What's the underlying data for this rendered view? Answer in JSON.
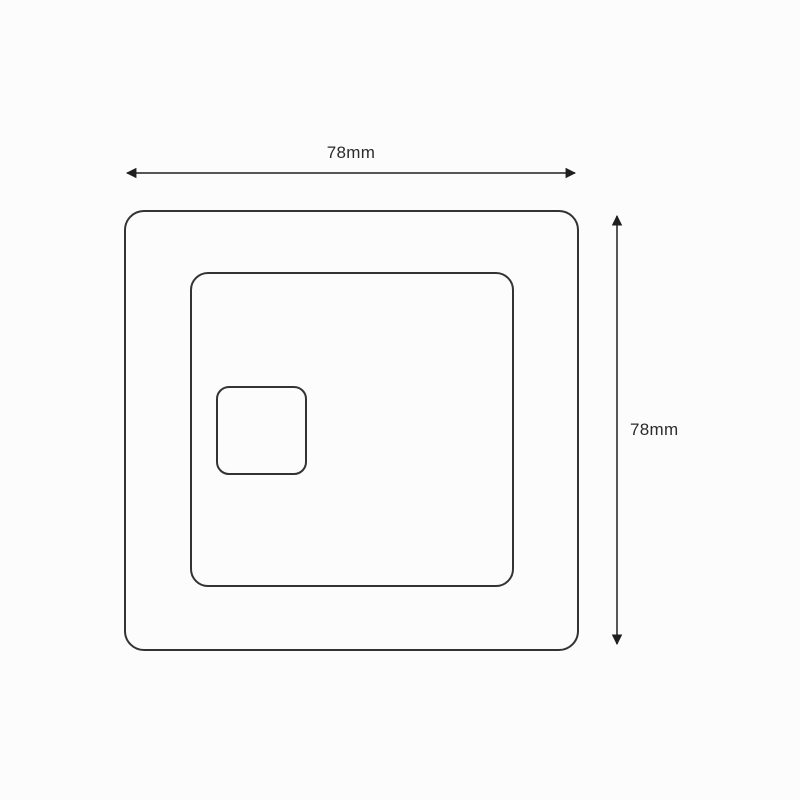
{
  "diagram": {
    "type": "technical-dimension-drawing",
    "subject": "square faceplate front view with nested rounded squares",
    "background_color": "#fcfcfc",
    "line_color": "#333333",
    "arrow_color": "#1f1f1f",
    "dimensions": {
      "width": {
        "label": "78mm",
        "value": 78,
        "unit": "mm",
        "orientation": "horizontal",
        "position": "top"
      },
      "height": {
        "label": "78mm",
        "value": 78,
        "unit": "mm",
        "orientation": "vertical",
        "position": "right"
      }
    },
    "shapes": [
      {
        "name": "outer-plate",
        "description": "large rounded square outline"
      },
      {
        "name": "inner-frame",
        "description": "medium rounded square outline inset toward bottom-left"
      },
      {
        "name": "button",
        "description": "small rounded square outline in upper-left of inner frame"
      }
    ]
  }
}
